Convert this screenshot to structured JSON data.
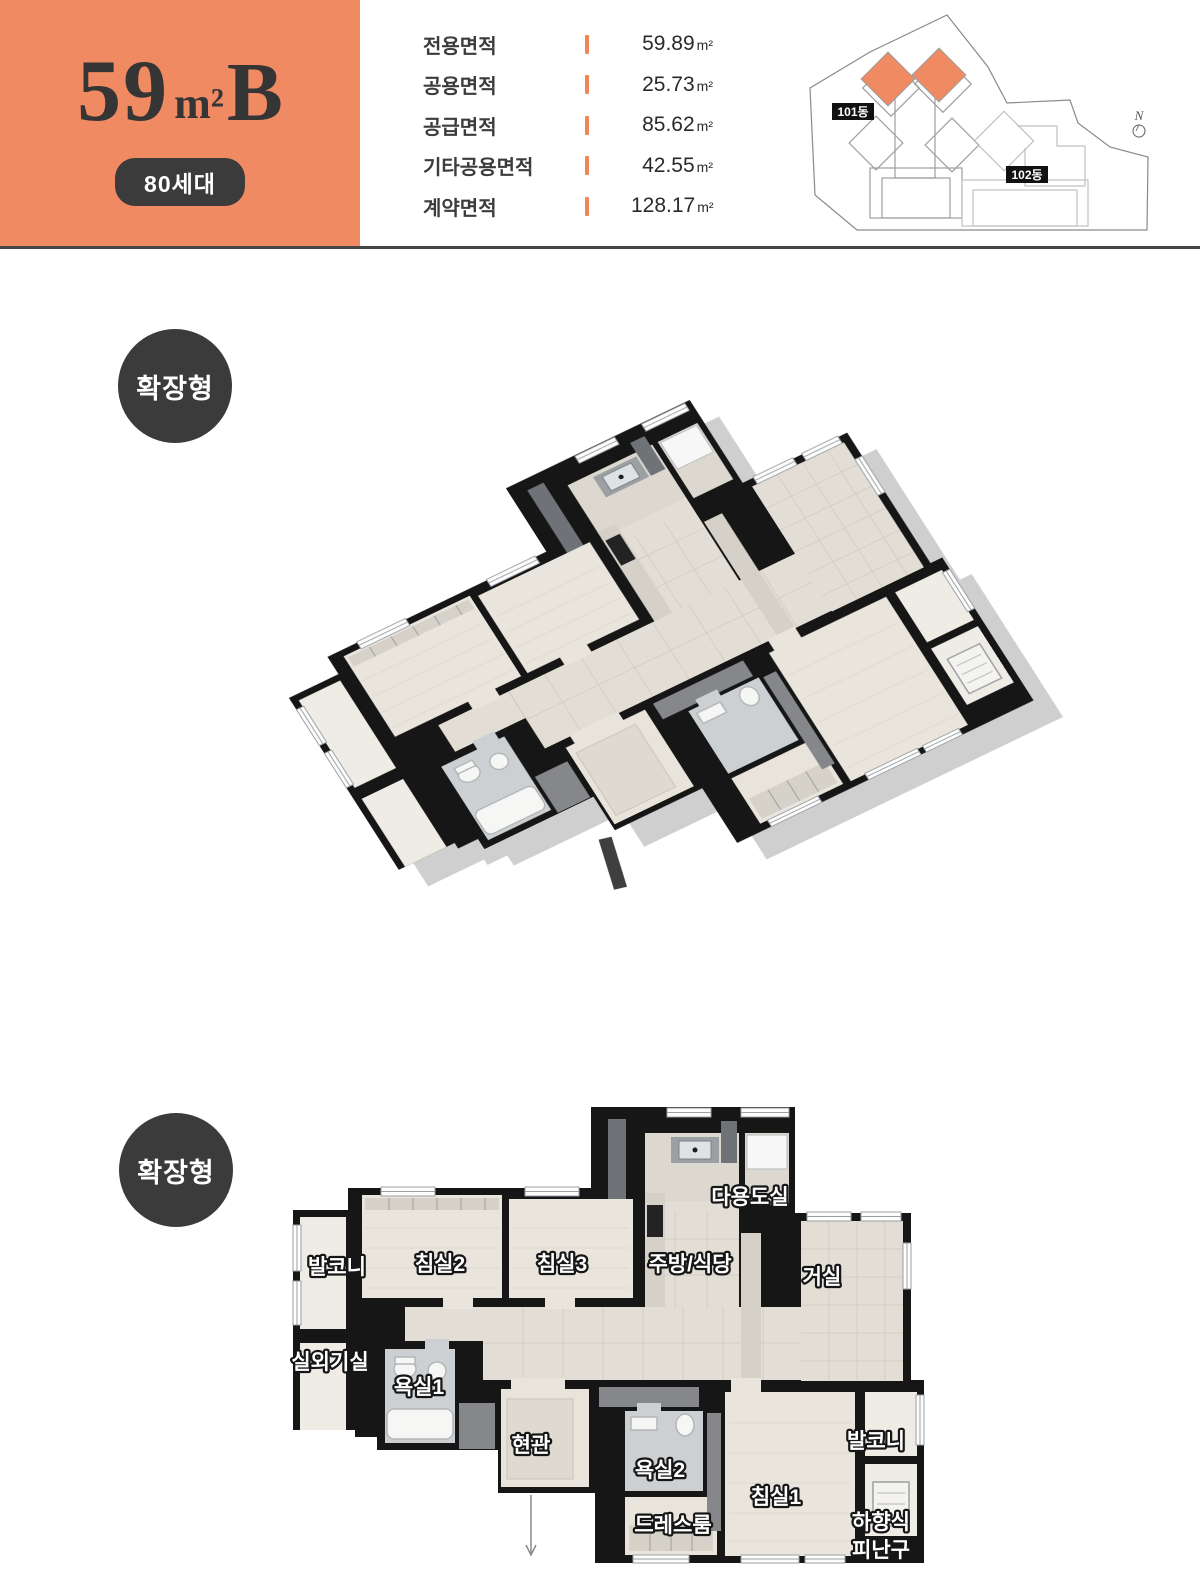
{
  "header": {
    "unit_title": {
      "number": "59",
      "unit": "m²",
      "suffix": "B"
    },
    "households_badge": "80세대",
    "area_table": [
      {
        "label": "전용면적",
        "value": "59.89",
        "unit": "m²"
      },
      {
        "label": "공용면적",
        "value": "25.73",
        "unit": "m²"
      },
      {
        "label": "공급면적",
        "value": "85.62",
        "unit": "m²"
      },
      {
        "label": "기타공용면적",
        "value": "42.55",
        "unit": "m²"
      },
      {
        "label": "계약면적",
        "value": "128.17",
        "unit": "m²"
      }
    ],
    "colors": {
      "accent": "#ef8a63",
      "dark": "#3b3b3b"
    }
  },
  "site_plan": {
    "building_101_label": "101동",
    "building_102_label": "102동",
    "north_label": "N"
  },
  "sections": {
    "iso_badge": "확장형",
    "flat_badge": "확장형"
  },
  "floor_plan": {
    "rooms": {
      "balcony_left": "발코니",
      "bedroom2": "침실2",
      "bedroom3": "침실3",
      "kitchen_dining": "주방/식당",
      "living": "거실",
      "utility": "다용도실",
      "outdoor_unit": "실외기실",
      "bath1": "욕실1",
      "entrance": "현관",
      "bath2": "욕실2",
      "dressroom": "드레스룸",
      "bedroom1": "침실1",
      "balcony_right": "발코니",
      "escape_line1": "하향식",
      "escape_line2": "피난구"
    }
  }
}
